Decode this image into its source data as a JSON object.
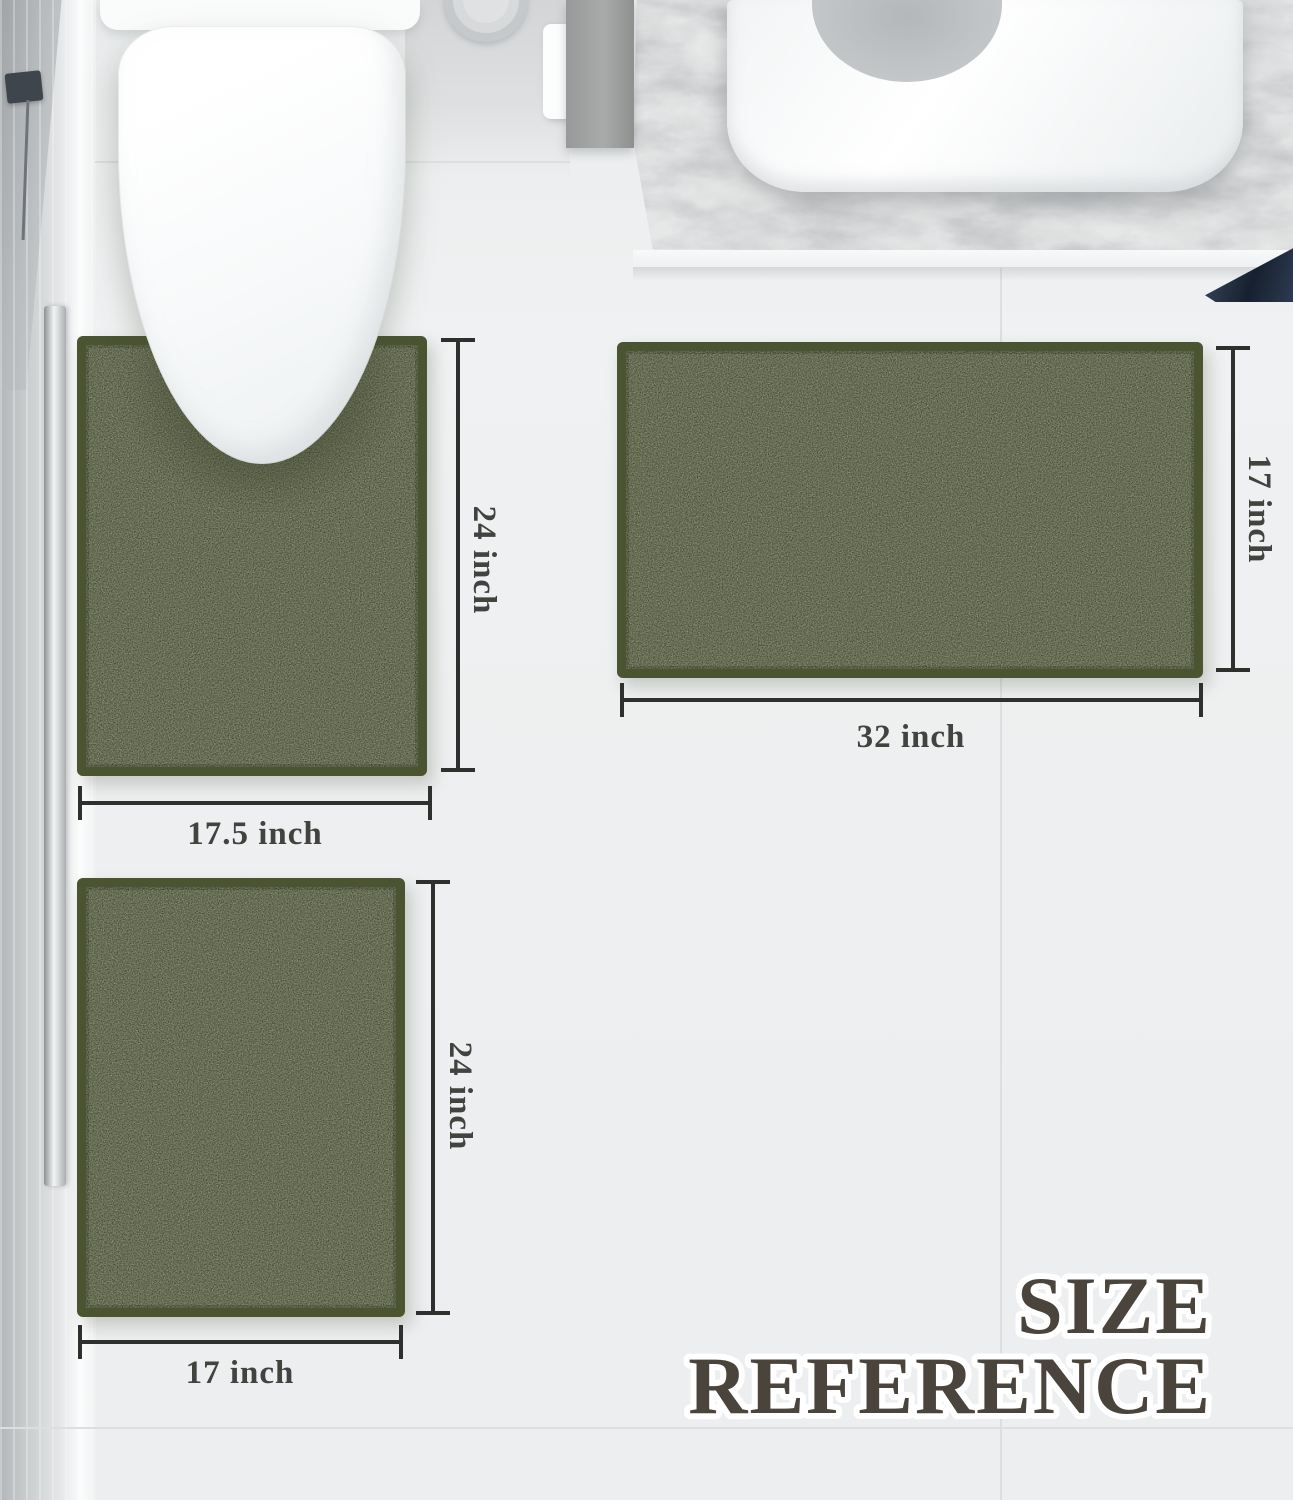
{
  "image": {
    "kind": "bath mat set size reference product graphic",
    "canvas": {
      "width": 1293,
      "height": 1500
    }
  },
  "title": {
    "line1": "SIZE",
    "line2": "REFERENCE"
  },
  "mats": {
    "contour": {
      "name": "U-shape contour toilet mat",
      "width_label": "17.5 inch",
      "height_label": "24 inch"
    },
    "large": {
      "name": "Large rectangular bath mat",
      "width_label": "32 inch",
      "height_label": "17 inch"
    },
    "small": {
      "name": "Small rectangular bath mat",
      "width_label": "17 inch",
      "height_label": "24 inch"
    }
  },
  "colors": {
    "rug_green": "#67704d",
    "rug_border": "#4b5431",
    "dimension_line": "#2f2f2d",
    "dimension_label": "#42423f",
    "title_fill": "#4a443c",
    "title_outline": "#ffffff",
    "towel_navy": "#232c3d",
    "floor": "#edeff0"
  }
}
